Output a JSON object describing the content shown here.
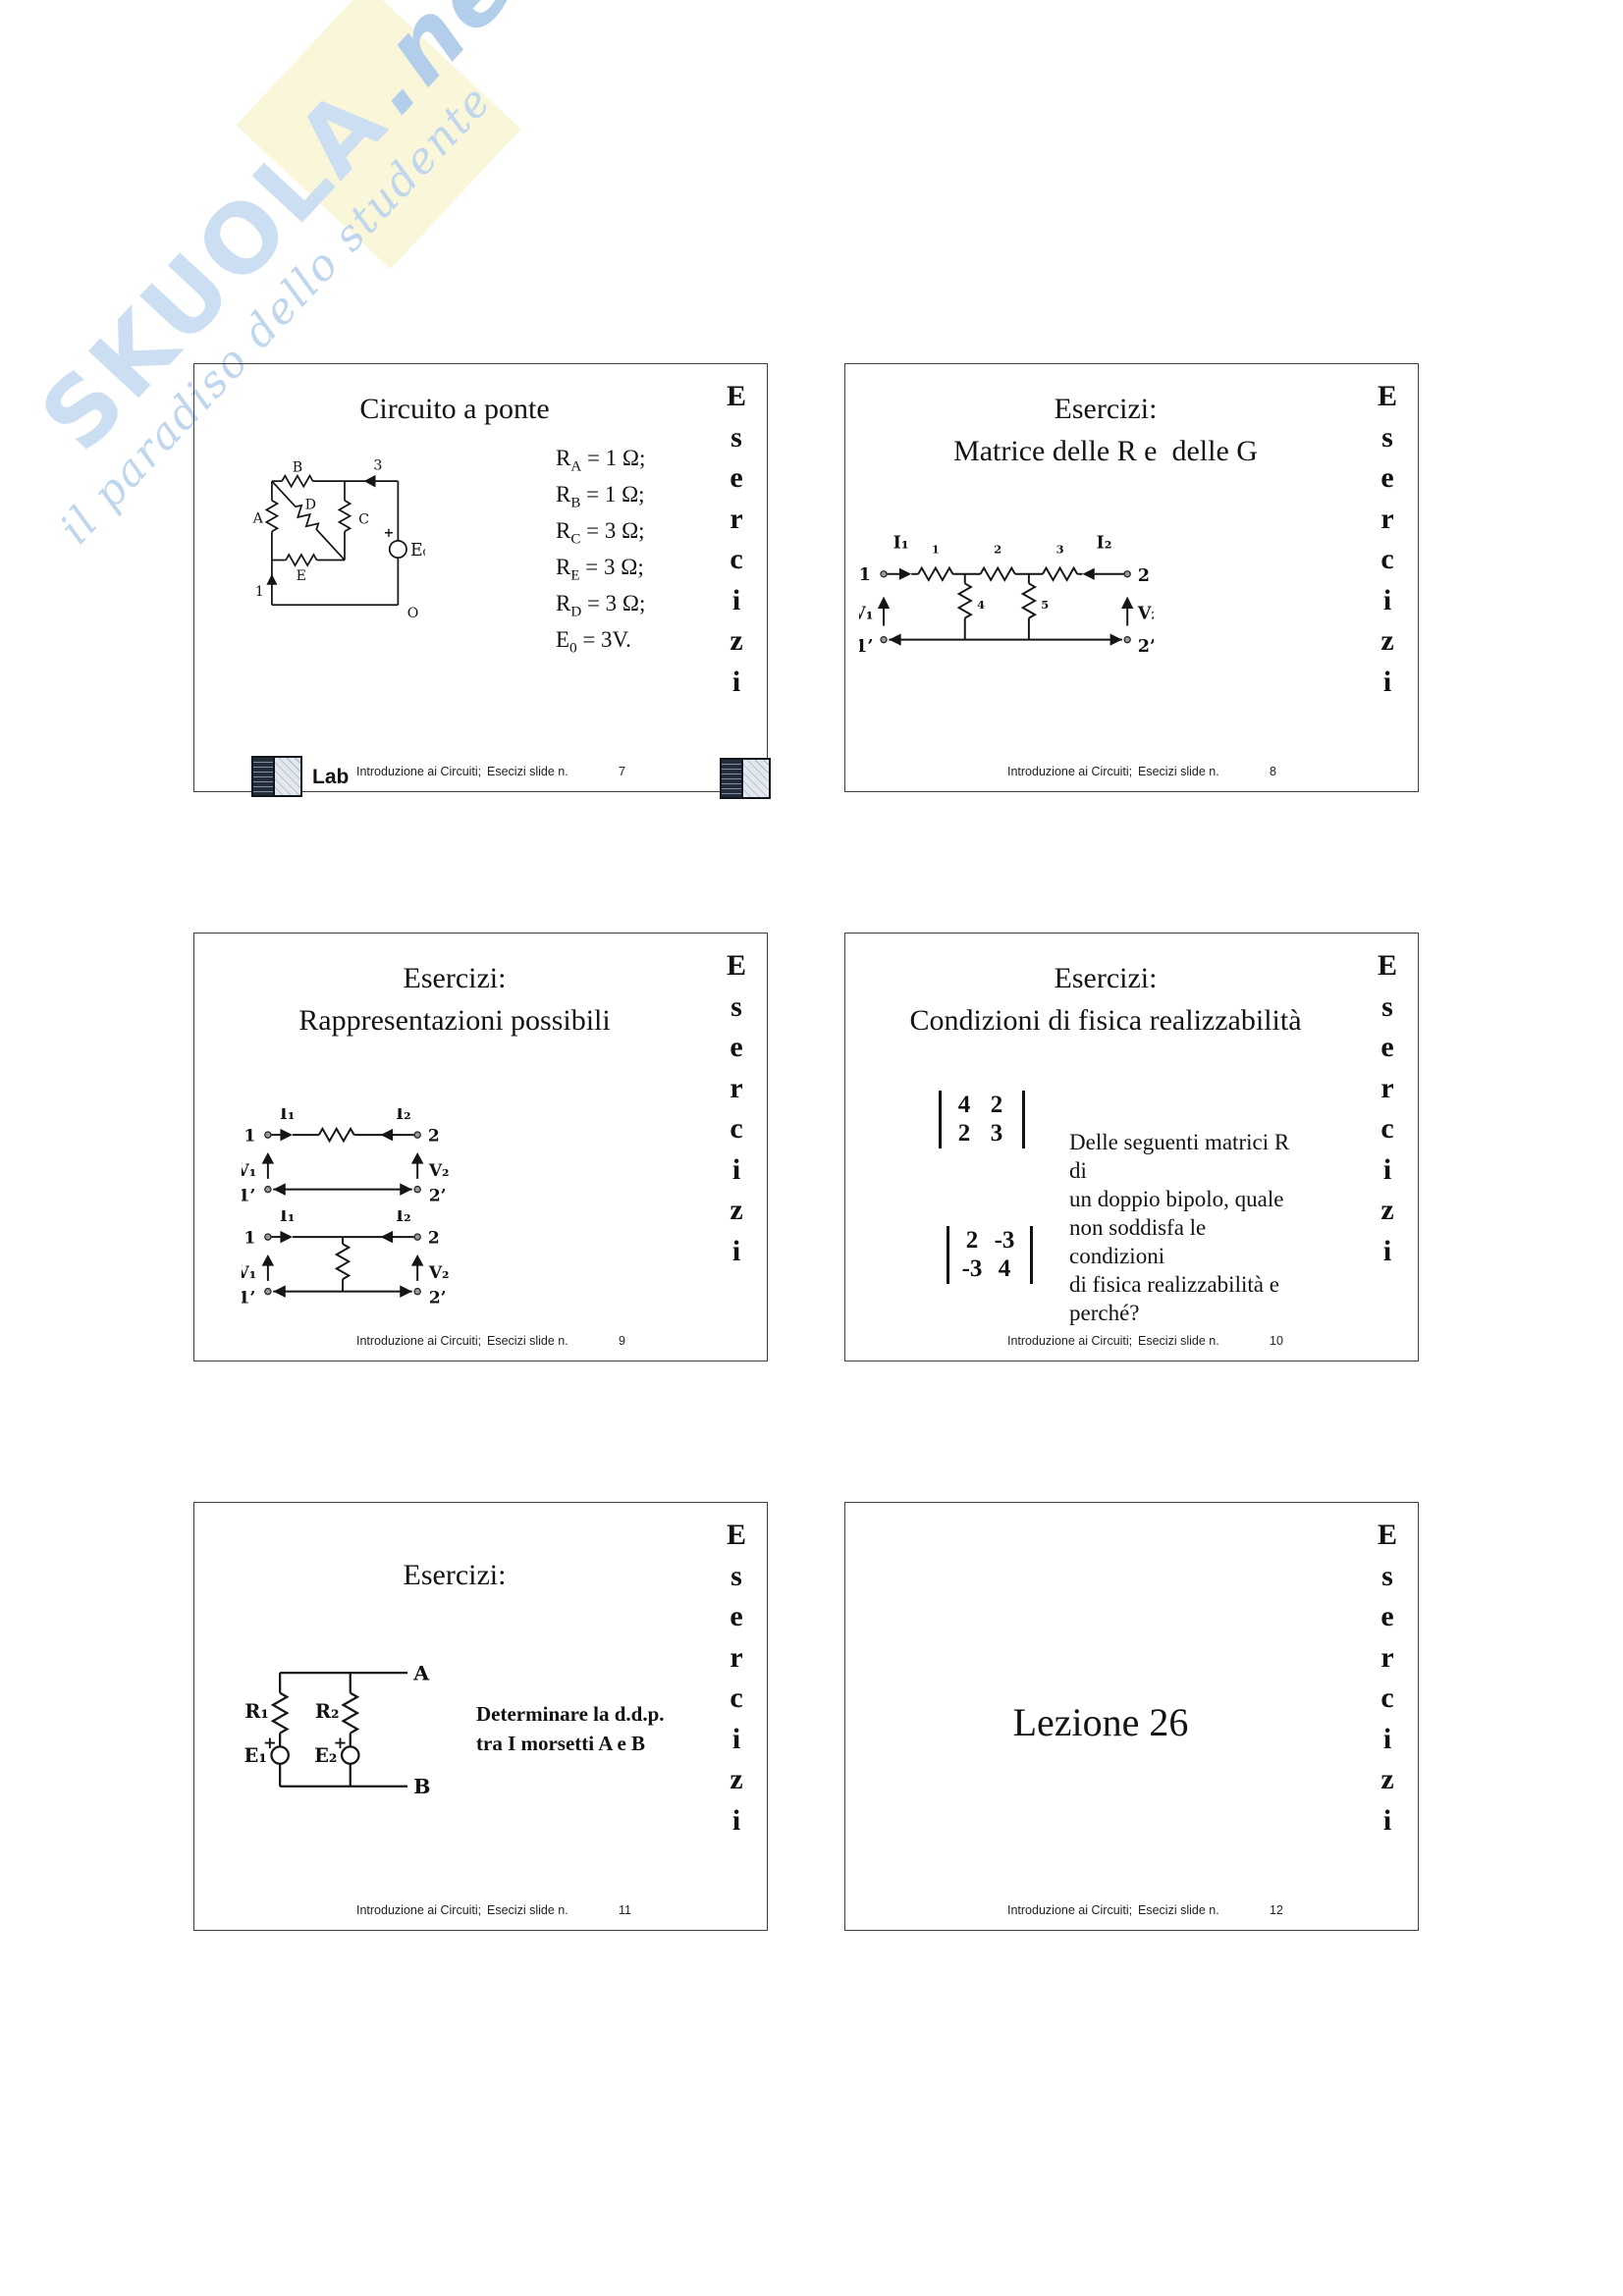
{
  "watermark": {
    "brand": "SKUOLA",
    "suffix": ".net",
    "tagline": "il paradiso dello studente",
    "blue": "#bfd6ec",
    "yellow": "#f9f5d2"
  },
  "esercizi_vertical": "E\ns\ne\nr\nc\ni\nz\ni",
  "footer": {
    "course": "Introduzione ai Circuiti;",
    "label": "Esecizi slide n."
  },
  "slides": [
    {
      "title": "Circuito a ponte",
      "number": "7",
      "lab": "Lab",
      "values": [
        {
          "sym": "R",
          "sub": "A",
          "rest": " = 1 Ω;"
        },
        {
          "sym": "R",
          "sub": "B",
          "rest": " = 1 Ω;"
        },
        {
          "sym": "R",
          "sub": "C",
          "rest": " = 3 Ω;"
        },
        {
          "sym": "R",
          "sub": "E",
          "rest": " = 3 Ω;"
        },
        {
          "sym": "R",
          "sub": "D",
          "rest": " = 3 Ω;"
        },
        {
          "sym": "E",
          "sub": "0",
          "rest": " = 3V."
        }
      ],
      "circuit": {
        "labels": {
          "A": "A",
          "B": "B",
          "C": "C",
          "D": "D",
          "E": "E",
          "n1": "1",
          "n3": "3",
          "nO": "O",
          "plus": "+",
          "source": "E₀"
        }
      }
    },
    {
      "title1": "Esercizi:",
      "title2": "Matrice delle R e  delle G",
      "number": "8",
      "circuit": {
        "labels": {
          "I1": "I₁",
          "I2": "I₂",
          "V1": "V₁",
          "V2": "V₂",
          "t1": "1",
          "t2": "2",
          "t1p": "1’",
          "t2p": "2’",
          "r1": "1",
          "r2": "2",
          "r3": "3",
          "r4": "4",
          "r5": "5"
        }
      }
    },
    {
      "title1": "Esercizi:",
      "title2": "Rappresentazioni possibili",
      "number": "9",
      "circuit": {
        "labels": {
          "I1": "I₁",
          "I2": "I₂",
          "V1": "V₁",
          "V2": "V₂",
          "t1": "1",
          "t2": "2",
          "t1p": "1’",
          "t2p": "2’"
        }
      }
    },
    {
      "title1": "Esercizi:",
      "title2": "Condizioni di fisica realizzabilità",
      "number": "10",
      "matrix1": [
        [
          "4",
          "2"
        ],
        [
          "2",
          "3"
        ]
      ],
      "matrix2": [
        [
          "2",
          "-3"
        ],
        [
          "-3",
          "4"
        ]
      ],
      "question": "Delle seguenti matrici R di\nun doppio bipolo, quale\nnon soddisfa le condizioni\ndi fisica realizzabilità e\nperché?"
    },
    {
      "title1": "Esercizi:",
      "number": "11",
      "task": "Determinare la d.d.p.\ntra I morsetti A e B",
      "circuit": {
        "labels": {
          "R1": "R₁",
          "R2": "R₂",
          "E1": "E₁",
          "E2": "E₂",
          "A": "A",
          "B": "B",
          "plus1": "+",
          "plus2": "+"
        }
      }
    },
    {
      "lesson": "Lezione 26",
      "number": "12"
    }
  ]
}
